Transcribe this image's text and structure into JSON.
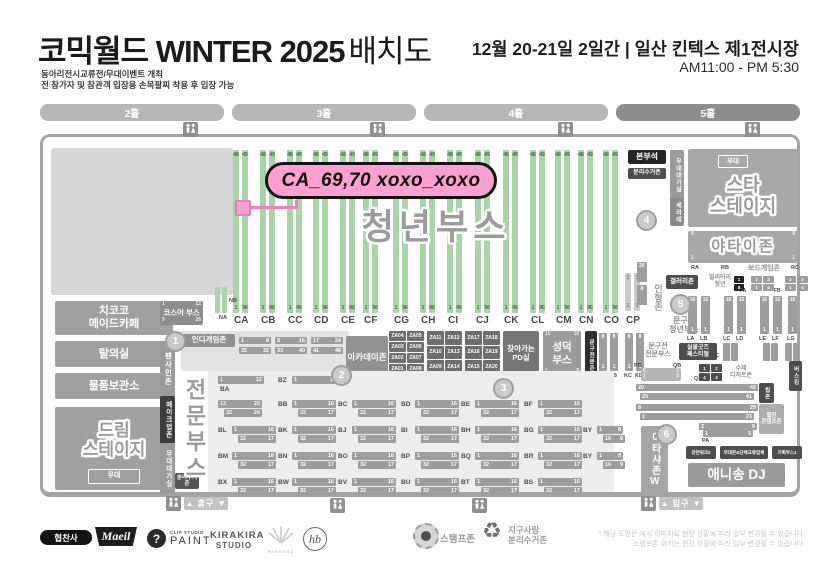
{
  "header": {
    "title_main": "코믹월드 WINTER 2025",
    "title_suffix": "배치도",
    "subtitle1": "동아리전시교류전/무대이벤트 개최",
    "subtitle2": "전 참가자 및 참관객 입장용 손목팔찌 착용 후 입장 가능",
    "date_venue": "12월 20-21일 2일간 | 일산 킨텍스 제1전시장",
    "hours": "AM11:00 - PM 5:30"
  },
  "halls": [
    "2홀",
    "3홀",
    "4홀",
    "5홀"
  ],
  "callout": {
    "text": "CA_69,70 xoxo_xoxo"
  },
  "youth": {
    "title": "청년부스",
    "columns": [
      "CA",
      "CB",
      "CC",
      "CD",
      "CE",
      "CF",
      "CG",
      "CH",
      "CI",
      "CJ",
      "CK",
      "CL",
      "CM",
      "CN",
      "CO",
      "CP"
    ],
    "top_nums": [
      "48",
      "49"
    ],
    "bottom_nums": [
      "1",
      "96"
    ],
    "cp_nums": [
      "1",
      "1"
    ],
    "mini_labels": [
      "NB",
      "NA"
    ]
  },
  "left": {
    "maid_cafe": "치코코\n메이드카페",
    "changing": "탈의실",
    "storage": "물품보관소",
    "dream_stage": "드림\n스테이지",
    "stage": "무대",
    "cosplay": "코스어 부스",
    "cosplay_nums": [
      "1",
      "22",
      "9",
      "26"
    ],
    "fan_sign": "팬사인존",
    "makeup": "메이크업존",
    "stage_wait": "무대대기실",
    "recycle": "분리수거존",
    "pro_booth": "전문부스",
    "indie": "인디게임존",
    "academy": "아카데미존",
    "academy_nums": [
      "1",
      "3"
    ]
  },
  "za_groups": [
    [
      [
        "ZA04",
        "ZA05"
      ],
      [
        "ZA03",
        "ZA06"
      ],
      [
        "ZA02",
        "ZA07"
      ],
      [
        "ZA01",
        "ZA08"
      ]
    ],
    [
      [
        "ZA11",
        "ZA12"
      ],
      [
        "ZA10",
        "ZA13"
      ],
      [
        "ZA09",
        "ZA14"
      ]
    ],
    [
      [
        "ZA17",
        "ZA18"
      ],
      [
        "ZA16",
        "ZA19"
      ],
      [
        "ZA15",
        "ZA20"
      ]
    ]
  ],
  "mid": {
    "pd_room": "찾아가는\nPD실",
    "seongdeok": "성덕\n부스",
    "seongdeok_nums": [
      "16",
      "10",
      "1",
      "8"
    ],
    "stationery_strip": "문구전문존",
    "strip_nums": [
      "2",
      "1"
    ],
    "k_cols": [
      "KA",
      "KB",
      "KC",
      "KD"
    ],
    "k_nums": [
      "8",
      "1"
    ]
  },
  "booths": {
    "rows": [
      [
        {
          "l": "BA",
          "pos": "below",
          "t": "single"
        },
        {
          "l": "BZ",
          "t": "single"
        }
      ],
      [
        {
          "l": "",
          "t": "cont"
        },
        {
          "l": "BB"
        },
        {
          "l": "BC"
        },
        {
          "l": "BD"
        },
        {
          "l": "BE"
        },
        {
          "l": "BF"
        }
      ],
      [
        {
          "l": "BL"
        },
        {
          "l": "BK"
        },
        {
          "l": "BJ"
        },
        {
          "l": "BI"
        },
        {
          "l": "BH"
        },
        {
          "l": "BG"
        },
        {
          "l": "BY",
          "t": "by"
        }
      ],
      [
        {
          "l": "BM"
        },
        {
          "l": "BN"
        },
        {
          "l": "BO"
        },
        {
          "l": "BP"
        },
        {
          "l": "BQ"
        },
        {
          "l": "BR"
        },
        {
          "l": "BY",
          "t": "by"
        }
      ],
      [
        {
          "l": "BX"
        },
        {
          "l": "BW"
        },
        {
          "l": "BV"
        },
        {
          "l": "BU"
        },
        {
          "l": "BT"
        },
        {
          "l": "BS"
        }
      ]
    ],
    "nums": {
      "single": [
        [
          "1",
          "12"
        ]
      ],
      "cont": [
        [
          "13",
          "23"
        ],
        [
          "32",
          "24"
        ]
      ],
      "std": [
        [
          "1",
          "16"
        ],
        [
          "32",
          "17"
        ]
      ],
      "by": [
        [
          "1",
          "8"
        ],
        [
          "16",
          "9"
        ]
      ]
    },
    "indie_bars": [
      [
        "1",
        "8"
      ],
      [
        "9",
        "16"
      ],
      [
        "17",
        "24"
      ],
      [
        "25",
        "32"
      ],
      [
        "33",
        "40"
      ],
      [
        "41",
        "48"
      ]
    ]
  },
  "right": {
    "hq": "본부석",
    "recycle": "분리수거존",
    "stage_wait": "무대대기실",
    "stage": "무대",
    "star_stage": "스타\n스테이지",
    "serate": "세라테",
    "yatai": "야타이존",
    "yatai_nums": [
      "8",
      "8",
      "1",
      "1"
    ],
    "yatai_cols": [
      "RA",
      "RB",
      "RC"
    ],
    "board_game": "보드게임존",
    "military": "밀리터리\n청년",
    "military_nums": [
      "1",
      "8"
    ],
    "gallery": "갤러리존",
    "doll": "인형존",
    "doll_nums": [
      "26",
      "8"
    ],
    "f_labels": [
      "FA",
      "FB"
    ],
    "f_nums": [
      "2",
      "3",
      "1",
      "4"
    ],
    "stationery_youth": "문구전\n청년부스",
    "l_cols": [
      "LA",
      "LB",
      "LC",
      "LD",
      "LE",
      "LF",
      "LG"
    ],
    "l_nums": [
      "16",
      "1"
    ],
    "stationery_pro": "문구전\n전문부스",
    "goods_fest": "실물굿즈\n페스티벌",
    "q_labels": [
      "QA",
      "QB",
      "QC"
    ],
    "p_labels": [
      "PA",
      "PB"
    ],
    "pb_nums": [
      "6",
      "3",
      "1",
      "8"
    ],
    "dessert": "수제\n디저트존",
    "busking": "버스킹",
    "tip": "팁존",
    "webzine": "웹진\n콘텐츠존",
    "p_bars": [
      [
        [
          "20",
          "42"
        ],
        [
          "25",
          "41"
        ]
      ],
      [
        [
          "8",
          "29"
        ],
        [
          "1",
          "23"
        ]
      ],
      [
        [
          "2",
          "6"
        ],
        [
          "1",
          "5"
        ]
      ]
    ],
    "itasha": "이타샤존W",
    "anisong": "애니송 DJ",
    "mini_blocks": [
      "강연워크2",
      "무대존&단체교류업체",
      "기획부스1"
    ]
  },
  "gates": {
    "exit": "▲ 출구 ▼",
    "entrance": "▲ 입구 ▼"
  },
  "markers": [
    "1",
    "2",
    "3",
    "4",
    "5",
    "6"
  ],
  "footer": {
    "sponsor": "협찬사",
    "maeil": "Maeil",
    "clip1": "CLIP STUDIO",
    "clip2": "PAINT",
    "kira1": "KIRAKIRA",
    "kira2": "STUDIO",
    "pancosa": "PANCOSA",
    "monogram": "hb",
    "stamp_zone": "스탬프존",
    "earth_recycle": "지구사랑\n분리수거존",
    "note1": "* 해당 도면은 예시 이미지로 현장 상황에 따라 일부 변경될 수 있습니다.",
    "note2": "스탬프존 위치는 현장 상황에 따라 일부 변경될 수 있습니다."
  }
}
